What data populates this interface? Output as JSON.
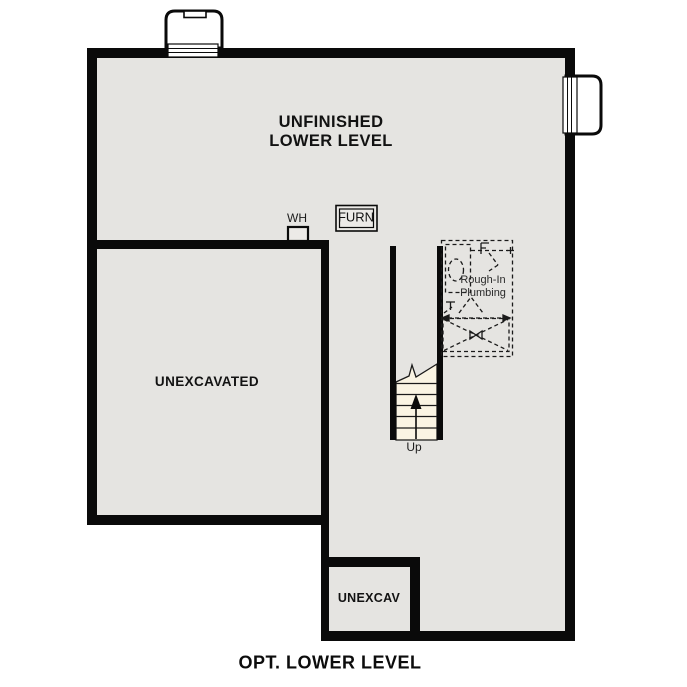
{
  "plan_title": "OPT. LOWER LEVEL",
  "labels": {
    "main_room_line1": "UNFINISHED",
    "main_room_line2": "LOWER LEVEL",
    "unexcavated": "UNEXCAVATED",
    "unexcav": "UNEXCAV",
    "water_heater": "WH",
    "furnace": "FURN",
    "rough_in_line1": "Rough-In",
    "rough_in_line2": "Plumbing",
    "stairs_up": "Up"
  },
  "colors": {
    "background": "#ffffff",
    "floor": "#e5e4e1",
    "wall": "#0a0a0a",
    "stair_tread": "#faf4e3",
    "dashed_fixture": "#1a1a1a",
    "text": "#121212"
  }
}
